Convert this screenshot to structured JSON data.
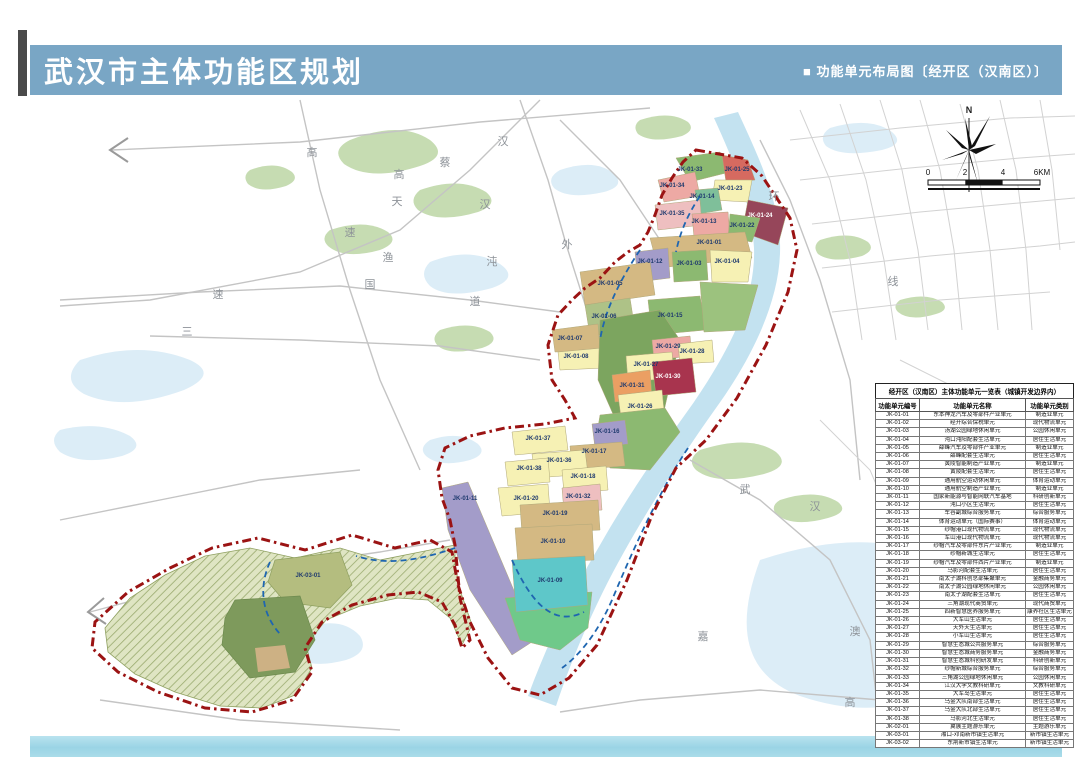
{
  "header": {
    "title": "武汉市主体功能区规划",
    "subtitle": "■ 功能单元布局图〔经开区（汉南区）〕"
  },
  "compass": {
    "north_label": "N"
  },
  "scalebar": {
    "ticks": [
      "0",
      "2",
      "4",
      "6KM"
    ]
  },
  "table": {
    "title": "经开区（汉南区）主体功能单元一览表（城镇开发边界内）",
    "columns": [
      "功能单元编号",
      "功能单元名称",
      "功能单元类别"
    ],
    "rows": [
      [
        "JK-01-01",
        "东本神龙汽车及零部件产业单元",
        "制造业单元"
      ],
      [
        "JK-01-02",
        "经开综合保税单元",
        "现代物流单元"
      ],
      [
        "JK-01-03",
        "汤湖公园绿地休闲单元",
        "公园休闲单元"
      ],
      [
        "JK-01-04",
        "沌口沌阳配套生活单元",
        "居住生活单元"
      ],
      [
        "JK-01-05",
        "薛峰汽车及零部件产业单元",
        "制造业单元"
      ],
      [
        "JK-01-06",
        "薛峰配套生活单元",
        "居住生活单元"
      ],
      [
        "JK-01-07",
        "黄陵智能制造产业单元",
        "制造业单元"
      ],
      [
        "JK-01-08",
        "黄陵配套生活单元",
        "居住生活单元"
      ],
      [
        "JK-01-09",
        "通用航空运动休闲单元",
        "体育运动单元"
      ],
      [
        "JK-01-10",
        "通用航空制造产业单元",
        "制造业单元"
      ],
      [
        "JK-01-11",
        "国家新能源与智能网联汽车基地",
        "科研创新单元"
      ],
      [
        "JK-01-12",
        "沌口小区生活单元",
        "居住生活单元"
      ],
      [
        "JK-01-13",
        "车谷副城综合服务单元",
        "综合服务单元"
      ],
      [
        "JK-01-14",
        "体育运动单元（国际赛事）",
        "体育运动单元"
      ],
      [
        "JK-01-15",
        "纱帽港口现代物流单元",
        "现代物流单元"
      ],
      [
        "JK-01-16",
        "军山港口现代物流单元",
        "现代物流单元"
      ],
      [
        "JK-01-17",
        "纱帽汽车及零部件东片产业单元",
        "制造业单元"
      ],
      [
        "JK-01-18",
        "纱帽新城生活单元",
        "居住生活单元"
      ],
      [
        "JK-01-19",
        "纱帽汽车及零部件西片产业单元",
        "制造业单元"
      ],
      [
        "JK-01-20",
        "马影河配套生活单元",
        "居住生活单元"
      ],
      [
        "JK-01-21",
        "南太子湖科创总部集聚单元",
        "金融商务单元"
      ],
      [
        "JK-01-22",
        "南太子湖公园绿地休闲单元",
        "公园休闲单元"
      ],
      [
        "JK-01-23",
        "南太子湖配套生活单元",
        "居住生活单元"
      ],
      [
        "JK-01-24",
        "三角湖现代商贸单元",
        "现代商贸单元"
      ],
      [
        "JK-01-25",
        "四新智慧医养服务单元",
        "康养社区生活单元"
      ],
      [
        "JK-01-26",
        "大军山生活单元",
        "居住生活单元"
      ],
      [
        "JK-01-27",
        "天外天生活单元",
        "居住生活单元"
      ],
      [
        "JK-01-28",
        "小军山生活单元",
        "居住生活单元"
      ],
      [
        "JK-01-29",
        "智慧生态城公共服务单元",
        "综合服务单元"
      ],
      [
        "JK-01-30",
        "智慧生态城商务服务单元",
        "金融商务单元"
      ],
      [
        "JK-01-31",
        "智慧生态城科创研发单元",
        "科研创新单元"
      ],
      [
        "JK-01-32",
        "纱帽新城综合服务单元",
        "综合服务单元"
      ],
      [
        "JK-01-33",
        "三角湖公园绿地休闲单元",
        "公园休闲单元"
      ],
      [
        "JK-01-34",
        "江汉大学文教科研单元",
        "文教科研单元"
      ],
      [
        "JK-01-35",
        "大军岛生活单元",
        "居住生活单元"
      ],
      [
        "JK-01-36",
        "乌金大队南部生活单元",
        "居住生活单元"
      ],
      [
        "JK-01-37",
        "乌金大队北部生活单元",
        "居住生活单元"
      ],
      [
        "JK-01-38",
        "马影河北生活单元",
        "居住生活单元"
      ],
      [
        "JK-02-01",
        "翼展主题游乐单元",
        "主题游乐单元"
      ],
      [
        "JK-03-01",
        "湘口-邓南新市镇生活单元",
        "新市镇生活单元"
      ],
      [
        "JK-03-02",
        "东荆新市镇生活单元",
        "新市镇生活单元"
      ]
    ]
  },
  "map_labels": [
    {
      "id": "JK-01-33",
      "x": 690,
      "y": 170
    },
    {
      "id": "JK-01-25",
      "x": 737,
      "y": 170
    },
    {
      "id": "JK-01-34",
      "x": 672,
      "y": 186
    },
    {
      "id": "JK-01-23",
      "x": 730,
      "y": 189
    },
    {
      "id": "JK-01-14",
      "x": 702,
      "y": 197
    },
    {
      "id": "JK-01-24",
      "x": 760,
      "y": 216,
      "light": true
    },
    {
      "id": "JK-01-35",
      "x": 672,
      "y": 214
    },
    {
      "id": "JK-01-13",
      "x": 704,
      "y": 222
    },
    {
      "id": "JK-01-22",
      "x": 742,
      "y": 226
    },
    {
      "id": "JK-01-01",
      "x": 709,
      "y": 243
    },
    {
      "id": "JK-01-12",
      "x": 650,
      "y": 262
    },
    {
      "id": "JK-01-03",
      "x": 689,
      "y": 264
    },
    {
      "id": "JK-01-04",
      "x": 727,
      "y": 262
    },
    {
      "id": "JK-01-05",
      "x": 610,
      "y": 284
    },
    {
      "id": "JK-01-06",
      "x": 604,
      "y": 317
    },
    {
      "id": "JK-01-15",
      "x": 670,
      "y": 316
    },
    {
      "id": "JK-01-07",
      "x": 570,
      "y": 339
    },
    {
      "id": "JK-01-08",
      "x": 576,
      "y": 357
    },
    {
      "id": "JK-01-29",
      "x": 668,
      "y": 347
    },
    {
      "id": "JK-01-28",
      "x": 692,
      "y": 352
    },
    {
      "id": "JK-01-27",
      "x": 646,
      "y": 365
    },
    {
      "id": "JK-01-30",
      "x": 668,
      "y": 377,
      "light": true
    },
    {
      "id": "JK-01-31",
      "x": 632,
      "y": 386
    },
    {
      "id": "JK-01-26",
      "x": 640,
      "y": 407
    },
    {
      "id": "JK-01-37",
      "x": 538,
      "y": 439
    },
    {
      "id": "JK-01-16",
      "x": 607,
      "y": 432
    },
    {
      "id": "JK-01-17",
      "x": 594,
      "y": 452
    },
    {
      "id": "JK-01-36",
      "x": 559,
      "y": 461
    },
    {
      "id": "JK-01-38",
      "x": 529,
      "y": 469
    },
    {
      "id": "JK-01-18",
      "x": 583,
      "y": 477
    },
    {
      "id": "JK-01-20",
      "x": 526,
      "y": 499
    },
    {
      "id": "JK-01-32",
      "x": 578,
      "y": 497
    },
    {
      "id": "JK-01-19",
      "x": 555,
      "y": 514
    },
    {
      "id": "JK-01-10",
      "x": 553,
      "y": 542
    },
    {
      "id": "JK-01-09",
      "x": 550,
      "y": 581
    },
    {
      "id": "JK-01-11",
      "x": 465,
      "y": 499
    },
    {
      "id": "JK-03-01",
      "x": 308,
      "y": 576
    }
  ],
  "road_labels": [
    {
      "text": "高",
      "x": 312,
      "y": 152
    },
    {
      "text": "蔡",
      "x": 445,
      "y": 162
    },
    {
      "text": "汉",
      "x": 503,
      "y": 141
    },
    {
      "text": "高",
      "x": 399,
      "y": 174
    },
    {
      "text": "天",
      "x": 397,
      "y": 201
    },
    {
      "text": "汉",
      "x": 485,
      "y": 204
    },
    {
      "text": "速",
      "x": 350,
      "y": 232
    },
    {
      "text": "渔",
      "x": 388,
      "y": 257
    },
    {
      "text": "沌",
      "x": 492,
      "y": 261
    },
    {
      "text": "外",
      "x": 567,
      "y": 244
    },
    {
      "text": "国",
      "x": 370,
      "y": 284
    },
    {
      "text": "道",
      "x": 475,
      "y": 301
    },
    {
      "text": "速",
      "x": 218,
      "y": 294
    },
    {
      "text": "三",
      "x": 187,
      "y": 331
    },
    {
      "text": "环",
      "x": 774,
      "y": 196
    },
    {
      "text": "线",
      "x": 893,
      "y": 281
    },
    {
      "text": "武",
      "x": 745,
      "y": 489
    },
    {
      "text": "汉",
      "x": 815,
      "y": 506
    },
    {
      "text": "嘉",
      "x": 703,
      "y": 636
    },
    {
      "text": "澳",
      "x": 855,
      "y": 631
    },
    {
      "text": "高",
      "x": 850,
      "y": 702
    }
  ],
  "colors": {
    "header_blue": "#79a6c5",
    "footer_cyan": "#9ad4e5",
    "boundary_red": "#9b1313",
    "edge_blue": "#1f66b0",
    "residential_yellow": "#f6f1b4",
    "industry_tan": "#d4b983",
    "park_green": "#8cb971",
    "sport_teal": "#5ec7c9",
    "logistics_purple": "#a39cc9",
    "service_pink": "#eda9a4",
    "commerce_maroon": "#96465a",
    "science_orange": "#eb9f63",
    "eco_olive": "#b9c48f",
    "water_blue": "#c3e2f0",
    "label_navy": "#1f3a6e"
  }
}
